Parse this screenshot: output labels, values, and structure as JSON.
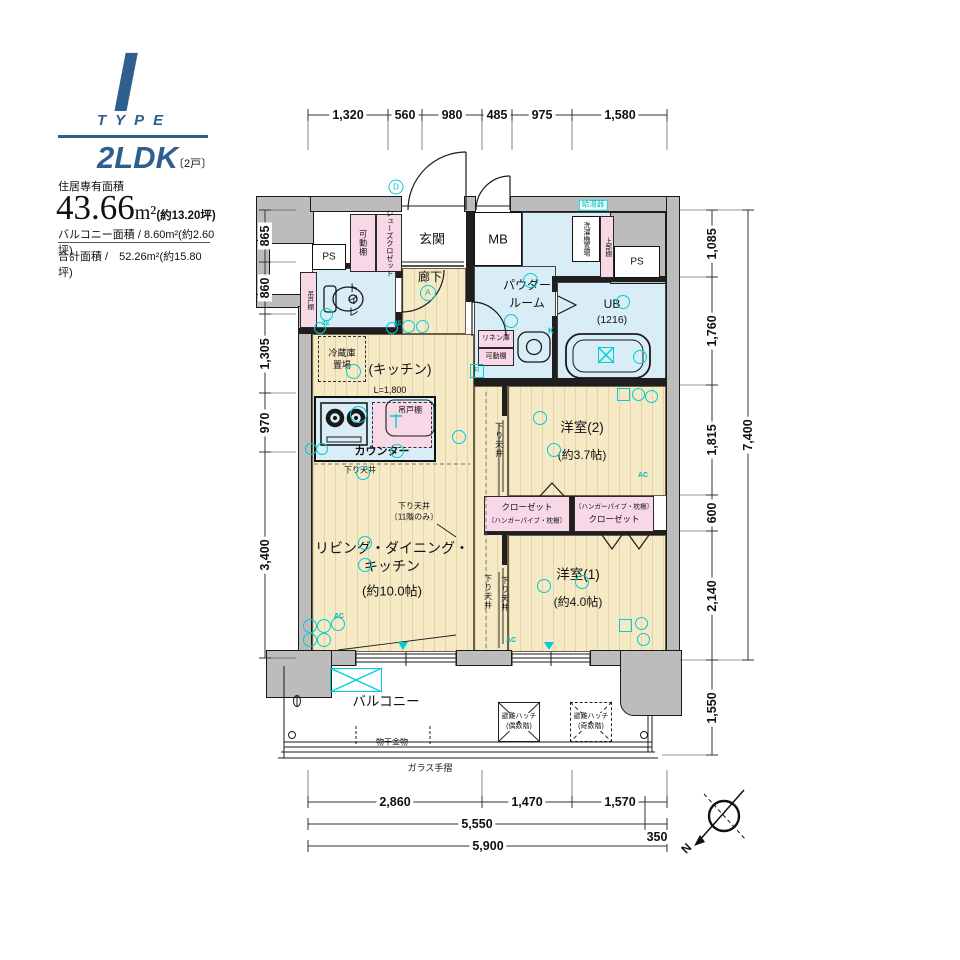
{
  "header": {
    "type_letter": "I",
    "type_word": "TYPE",
    "plan_type": "2LDK",
    "units_note": "〔2戸〕",
    "area_label": "住居専有面積",
    "area_value": "43.66",
    "area_unit": "m²",
    "area_tsubo": "(約13.20坪)",
    "balcony_line": "バルコニー面積 / 8.60m²(約2.60坪)",
    "total_line": "合計面積 /　52.26m²(約15.80坪)"
  },
  "plan": {
    "rooms": {
      "entrance": "玄関",
      "mb": "MB",
      "corridor": "廊下",
      "toilet": "トイレ",
      "powder1": "パウダー",
      "powder2": "ルーム",
      "ub1": "UB",
      "ub2": "(1216)",
      "kitchen": "(キッチン)",
      "kitchen_l": "L=1,800",
      "counter": "カウンター",
      "fridge1": "冷蔵庫",
      "fridge2": "置場",
      "hang_cupboard": "吊戸棚",
      "shoes_closet": "シューズクロゼット",
      "movable_shelf": "可動棚",
      "ps": "PS",
      "water_heater": "給湯器",
      "washer": "洗濯機置場",
      "upper_shelf": "上部棚",
      "linen": "リネン庫",
      "room2": "洋室(2)",
      "room2_size": "(約3.7帖)",
      "room1": "洋室(1)",
      "room1_size": "(約4.0帖)",
      "ldk1": "リビング・ダイニング・",
      "ldk2": "キッチン",
      "ldk_size": "(約10.0帖)",
      "closet": "クローゼット",
      "hanger_note": "〔ハンガーパイプ・枕棚〕",
      "lowered_ceiling": "下り天井",
      "lowered_note1": "下り天井",
      "lowered_note2": "〔11階のみ〕",
      "balcony": "バルコニー",
      "hatch1": "避難ハッチ",
      "hatch_even": "(偶数階)",
      "hatch_odd": "(奇数階)",
      "laundry": "物干金物",
      "glass_rail": "ガラス手摺"
    },
    "ann": {
      "d": "D",
      "a": "A",
      "k": "K",
      "r": "R",
      "ac": "AC",
      "e2": "2E"
    },
    "compass_n": "N"
  },
  "dims": {
    "top": [
      "1,320",
      "560",
      "980",
      "485",
      "975",
      "1,580"
    ],
    "left": [
      "865",
      "860",
      "1,305",
      "970",
      "3,400"
    ],
    "right": [
      "1,085",
      "1,760",
      "1,815",
      "600",
      "2,140"
    ],
    "right_total": "7,400",
    "right_balcony": "1,550",
    "bottom1": [
      "2,860",
      "1,470",
      "1,570"
    ],
    "bottom2": [
      "5,550",
      "350"
    ],
    "bottom3": "5,900"
  }
}
